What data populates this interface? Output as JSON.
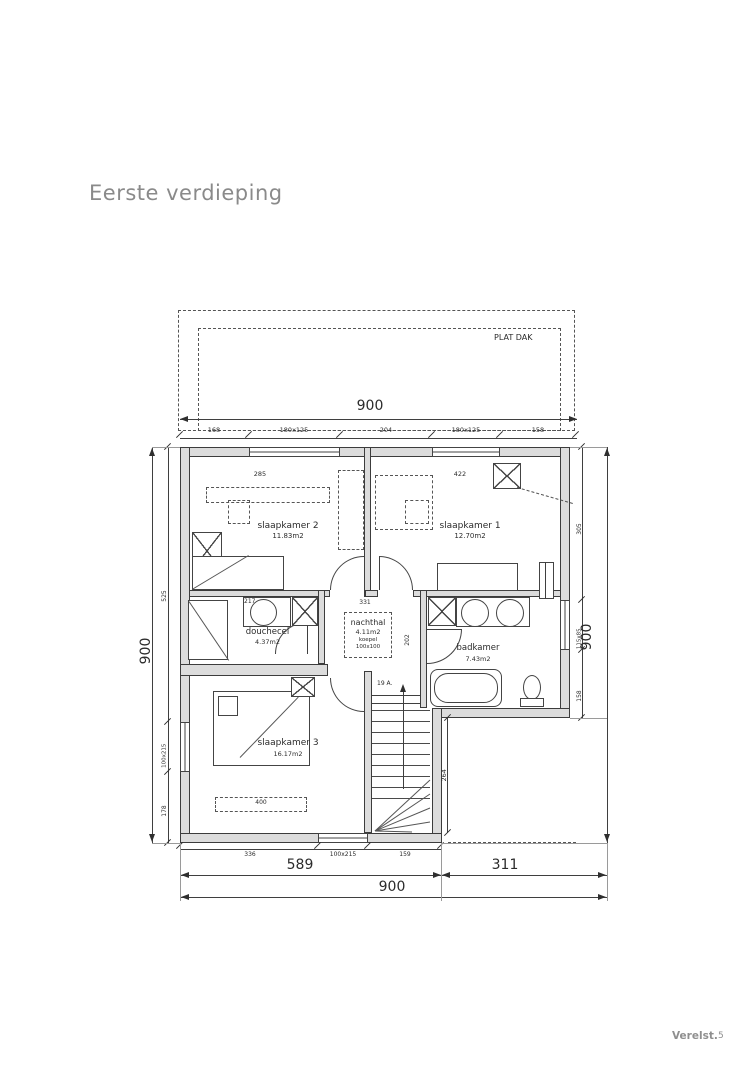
{
  "page": {
    "title": "Eerste verdieping",
    "footer_logo": "Verelst.",
    "page_number": "5"
  },
  "plan": {
    "roof_label": "PLAT DAK",
    "stairs_label": "19 A.",
    "rooms": {
      "slaapkamer2": {
        "name": "slaapkamer 2",
        "area": "11.83m2"
      },
      "slaapkamer1": {
        "name": "slaapkamer 1",
        "area": "12.70m2"
      },
      "douchecel": {
        "name": "douchecel",
        "area": "4.37m2"
      },
      "nachthal": {
        "name": "nachthal",
        "area": "4.11m2",
        "skylight": "koepel",
        "skylight_size": "100x100"
      },
      "badkamer": {
        "name": "badkamer",
        "area": "7.43m2"
      },
      "slaapkamer3": {
        "name": "slaapkamer 3",
        "area": "16.17m2"
      }
    },
    "dims": {
      "top_total": "900",
      "top_segments": [
        "168",
        "180x125",
        "204",
        "180x125",
        "158"
      ],
      "slaapkamer2_width": "285",
      "slaapkamer1_width": "422",
      "nachthal_width": "331",
      "douchecel_counter": "217",
      "nachthal_side": "202",
      "bed_width": "400",
      "cutout_height": "264",
      "bottom_segments": [
        "336",
        "100x215",
        "159"
      ],
      "bottom_left": "589",
      "bottom_right": "311",
      "bottom_total": "900",
      "left_total": "900",
      "left_segments": [
        "525",
        "100x215",
        "178"
      ],
      "right_total": "900",
      "right_segments": [
        "305",
        "115x85",
        "158"
      ]
    }
  }
}
